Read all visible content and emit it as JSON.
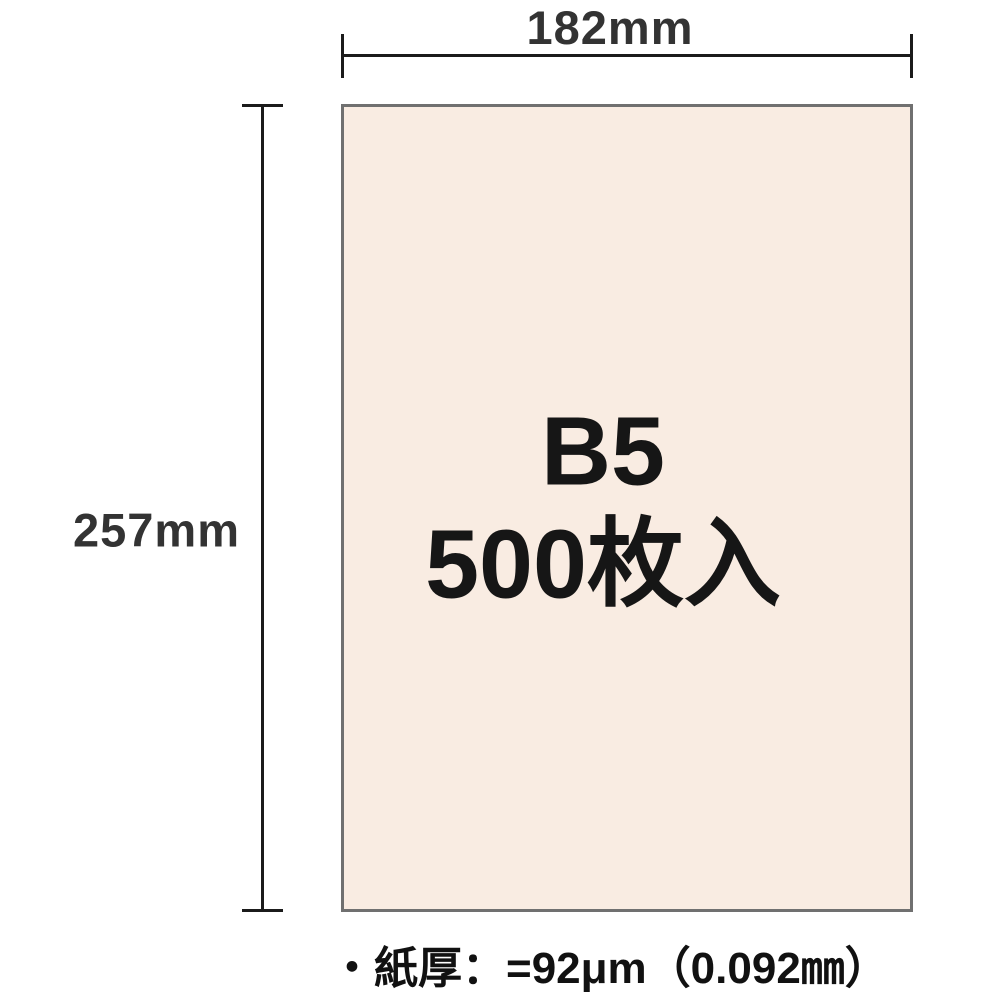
{
  "paper": {
    "size_label": "B5",
    "count_label": "500枚入",
    "fill_color": "#f9ece2",
    "border_color": "#707070",
    "text_color": "#161616"
  },
  "dimensions": {
    "width_label": "182mm",
    "height_label": "257mm",
    "line_color": "#1b1b1b",
    "label_color": "#333333"
  },
  "caption": {
    "text": "・紙厚：=92μm（0.092㎜）",
    "color": "#111111"
  },
  "page": {
    "background_color": "#ffffff"
  }
}
